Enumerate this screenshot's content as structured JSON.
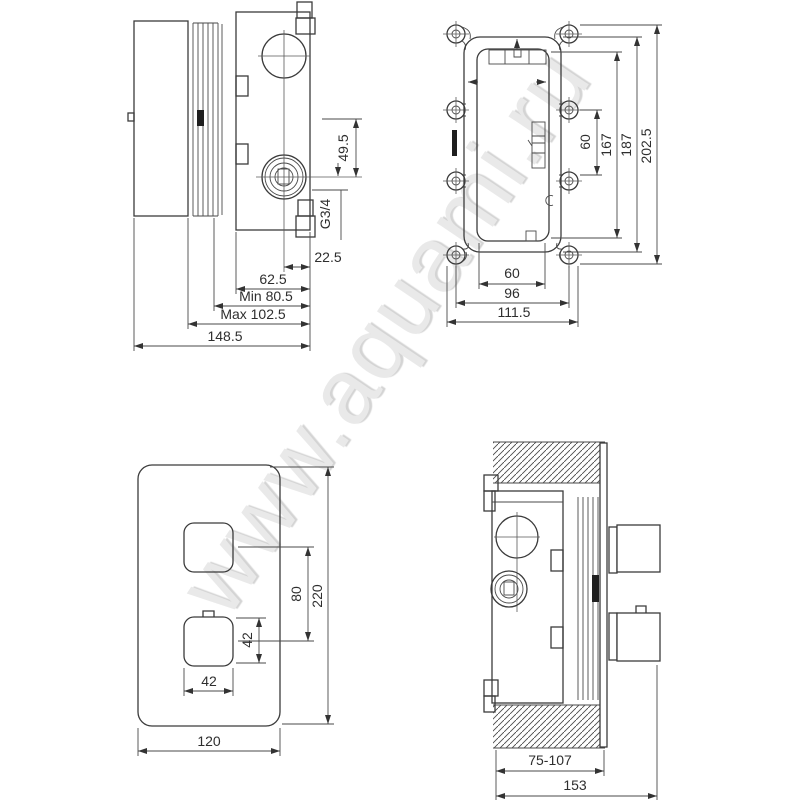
{
  "watermark": "www.aquami.ru",
  "views": {
    "side": {
      "name": "valve-side-view",
      "dims": {
        "port_height": "49.5",
        "thread": "G3/4",
        "axis_to_face": "22.5",
        "body_depth": "62.5",
        "min_depth": "Min 80.5",
        "max_depth": "Max 102.5",
        "total_depth": "148.5"
      }
    },
    "front": {
      "name": "rough-in-box-front-view",
      "dims": {
        "bracket_height": "60",
        "inner_height": "167",
        "frame_height": "187",
        "overall_height": "202.5",
        "inner_width": "60",
        "screw_spacing_width": "96",
        "overall_width": "111.5"
      }
    },
    "plate": {
      "name": "trim-plate-front-view",
      "dims": {
        "handle_spacing": "80",
        "plate_height": "220",
        "handle_height": "42",
        "handle_width": "42",
        "plate_width": "120"
      }
    },
    "installed": {
      "name": "installed-side-view",
      "dims": {
        "install_depth_range": "75-107",
        "overall_depth": "153"
      }
    }
  }
}
